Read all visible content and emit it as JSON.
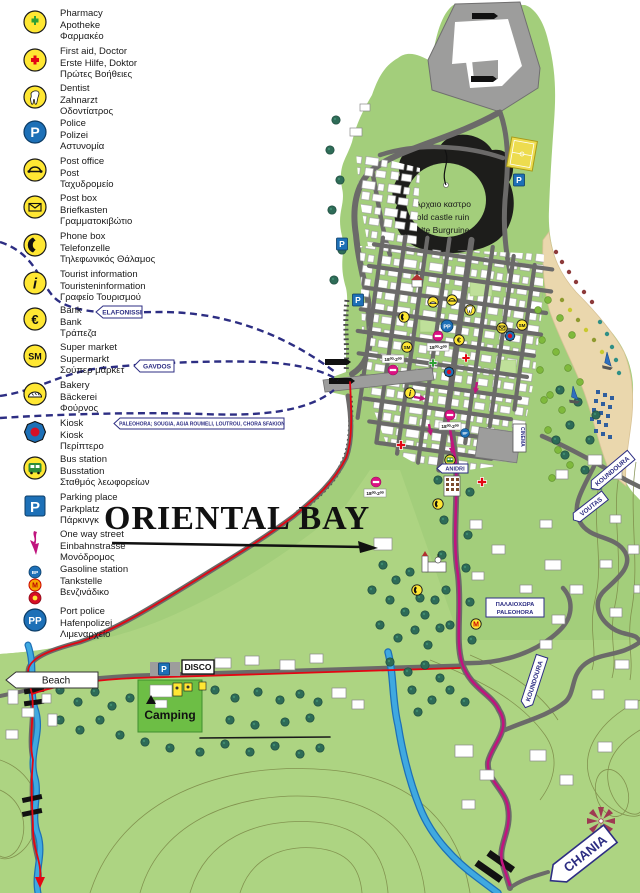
{
  "title": {
    "text": "ORIENTAL BAY"
  },
  "legend": {
    "items": [
      {
        "id": "pharmacy",
        "en": "Pharmacy",
        "de": "Apotheke",
        "gr": "Φαρμακέο"
      },
      {
        "id": "first-aid",
        "en": "First aid, Doctor",
        "de": "Erste Hilfe, Doktor",
        "gr": "Πρώτες Βοήθειες"
      },
      {
        "id": "dentist",
        "en": "Dentist",
        "de": "Zahnarzt",
        "gr": "Οδοντίατρος"
      },
      {
        "id": "police",
        "en": "Police",
        "de": "Polizei",
        "gr": "Αστυνομία"
      },
      {
        "id": "post-office",
        "en": "Post office",
        "de": "Post",
        "gr": "Ταχυδρομείο"
      },
      {
        "id": "post-box",
        "en": "Post box",
        "de": "Briefkasten",
        "gr": "Γραμματοκιβώτιο"
      },
      {
        "id": "phone-box",
        "en": "Phone box",
        "de": "Telefonzelle",
        "gr": "Τηλεφωνικός Θάλαμος"
      },
      {
        "id": "tourist-info",
        "en": "Tourist information",
        "de": "Touristeninformation",
        "gr": "Γραφείο Τουρισμού"
      },
      {
        "id": "bank",
        "en": "Bank",
        "de": "Bank",
        "gr": "Τράπεζα"
      },
      {
        "id": "supermarket",
        "en": "Super market",
        "de": "Supermarkt",
        "gr": "Σούπερ μάρκετ"
      },
      {
        "id": "bakery",
        "en": "Bakery",
        "de": "Bäckerei",
        "gr": "Φούρνος"
      },
      {
        "id": "kiosk",
        "en": "Kiosk",
        "de": "Kiosk",
        "gr": "Περίπτερο"
      },
      {
        "id": "bus-station",
        "en": "Bus station",
        "de": "Busstation",
        "gr": "Σταθμός λεωφορείων"
      },
      {
        "id": "parking",
        "en": "Parking place",
        "de": "Parkplatz",
        "gr": "Πάρκινγκ"
      },
      {
        "id": "one-way",
        "en": "One way street",
        "de": "Einbahnstrasse",
        "gr": "Μονόδρομος"
      },
      {
        "id": "gasoline",
        "en": "Gasoline station",
        "de": "Tankstelle",
        "gr": "Βενζινάδικο"
      },
      {
        "id": "port-police",
        "en": "Port police",
        "de": "Hafenpolizei",
        "gr": "Λιμεναρχείο"
      }
    ]
  },
  "map": {
    "castle_label": {
      "gr": "Αρχαιο καστρο",
      "en": "old castle ruin",
      "de": "alte Burgruine"
    },
    "ferry_routes": {
      "elafonissi": "ELAFONISSI",
      "gavdos": "GAVDOS",
      "south_coast": "PALEOHORA; SOUGIA, AGIA ROUMELI, LOUTROU, CHORA SFAKION"
    },
    "signs": {
      "anidri": "ANIDRI",
      "koundoura": "KOUNDOURA",
      "voutas": "VOUTAS",
      "chania": "CHANIA",
      "paleohora_gr": "ΠΑΛΑΙΟΧΩΡΑ",
      "paleohora_en": "PALEOHORA",
      "beach": "Beach",
      "disco": "DISCO",
      "camping": "Camping",
      "cinema": "CINEMA",
      "hours": "18⁰⁰-2⁰⁰"
    }
  },
  "glyphs": {
    "parking": "P",
    "police": "P",
    "port_police": "PP",
    "supermarket": "SM",
    "bank": "€",
    "info": "i",
    "metro": "M",
    "bp": "BP",
    "gas_m": "M"
  },
  "colors": {
    "land": "#A3CE7B",
    "land_light": "#AFD584",
    "beach": "#EAD7AD",
    "road": "#6B6A69",
    "harbor": "#9D9D9C",
    "route_red": "#E30613",
    "route_magenta": "#C0147E",
    "river": "#3FA9E0",
    "ferry_dash": "#2D2E83",
    "legend_yellow": "#FFE733",
    "sign_navy": "#2D2E83"
  }
}
